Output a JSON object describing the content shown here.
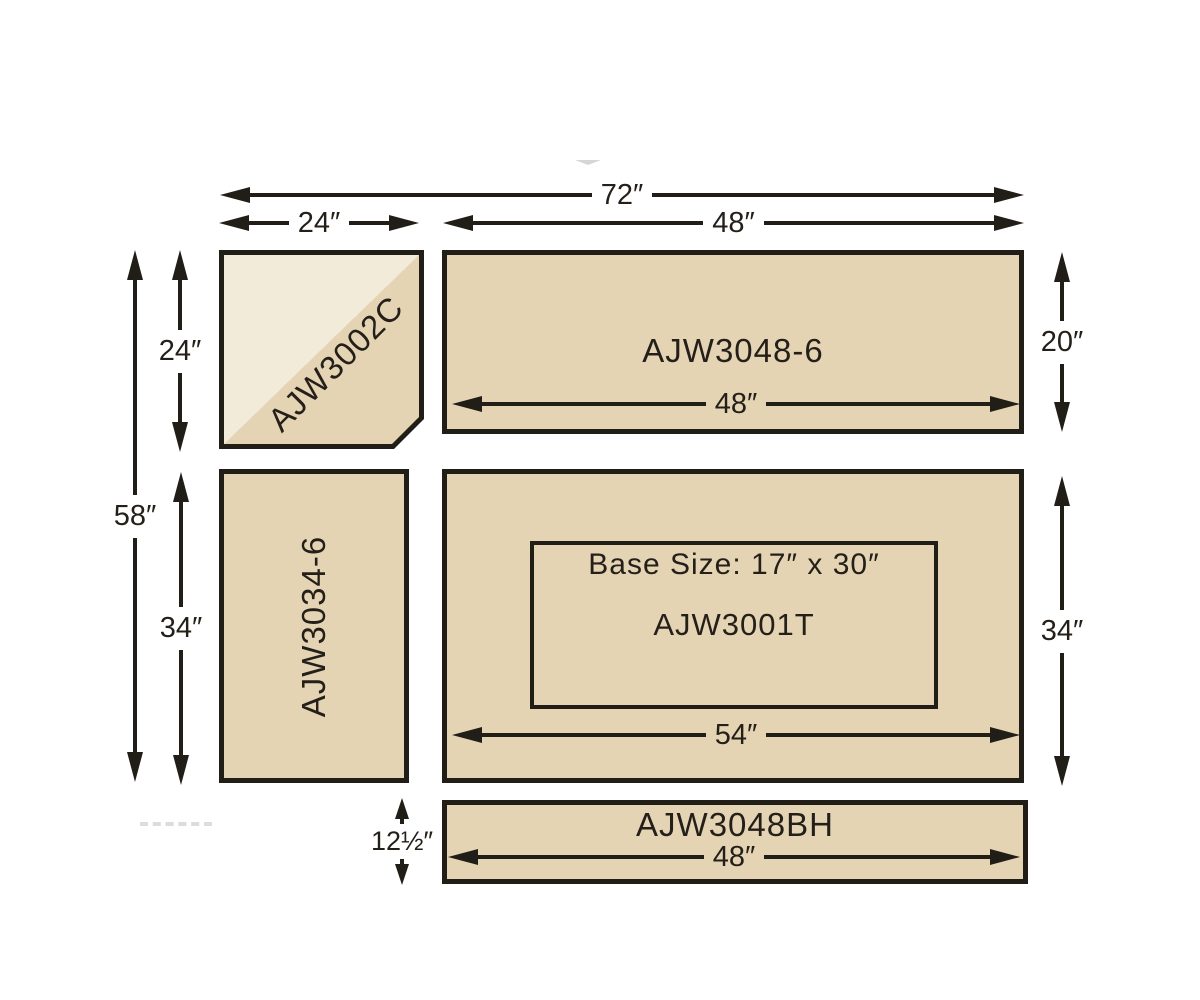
{
  "diagram": {
    "type": "countertop-panel-dimension-diagram",
    "panels": {
      "corner": {
        "label": "AJW3002C"
      },
      "top_right": {
        "label": "AJW3048-6",
        "width": "48″"
      },
      "left": {
        "label": "AJW3034-6"
      },
      "main": {
        "label": "AJW3001T",
        "base_size": "Base Size: 17″ x 30″",
        "width": "54″"
      },
      "bottom": {
        "label": "AJW3048BH",
        "width": "48″"
      }
    },
    "dims": {
      "overall_width": "72″",
      "corner_width": "24″",
      "right_width": "48″",
      "top_right_height": "20″",
      "overall_height": "58″",
      "corner_height": "24″",
      "left_height": "34″",
      "main_height": "34″",
      "bottom_height": "12½″"
    },
    "colors": {
      "panel_fill": "#e4d4b4",
      "panel_fill_light": "#f3ebda",
      "line": "#211d17",
      "background": "#ffffff"
    }
  }
}
